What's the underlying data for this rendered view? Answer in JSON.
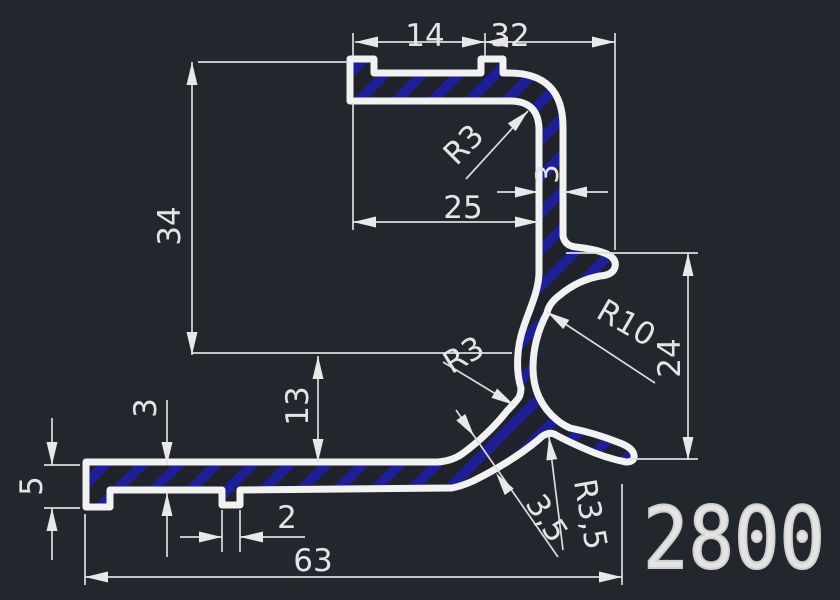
{
  "drawing": {
    "type": "cad-profile-cross-section",
    "part_number": "2800",
    "colors": {
      "background": "#22262d",
      "profile_line": "#f2f2f2",
      "hatch_blue": "#1e1e96",
      "hatch_base": "#1f222a",
      "dimension_line": "#dcdcdc",
      "dimension_text": "#e4e4e4",
      "part_number_color": "#cfcfcf"
    },
    "dimensions": {
      "top_left_width": "14",
      "top_right_width": "32",
      "upper_height": "34",
      "top_depth": "25",
      "wall_thickness": "3",
      "channel_height": "24",
      "web_drop": "13",
      "flange_thickness": "3",
      "lip_height": "5",
      "groove_width": "2",
      "overall_width": "63"
    },
    "radius_labels": {
      "top_inner_corner": "R3",
      "channel_bore": "R10",
      "web_corner": "R3",
      "web_thickness": "3,5",
      "hook_fillet": "R3,5"
    }
  }
}
